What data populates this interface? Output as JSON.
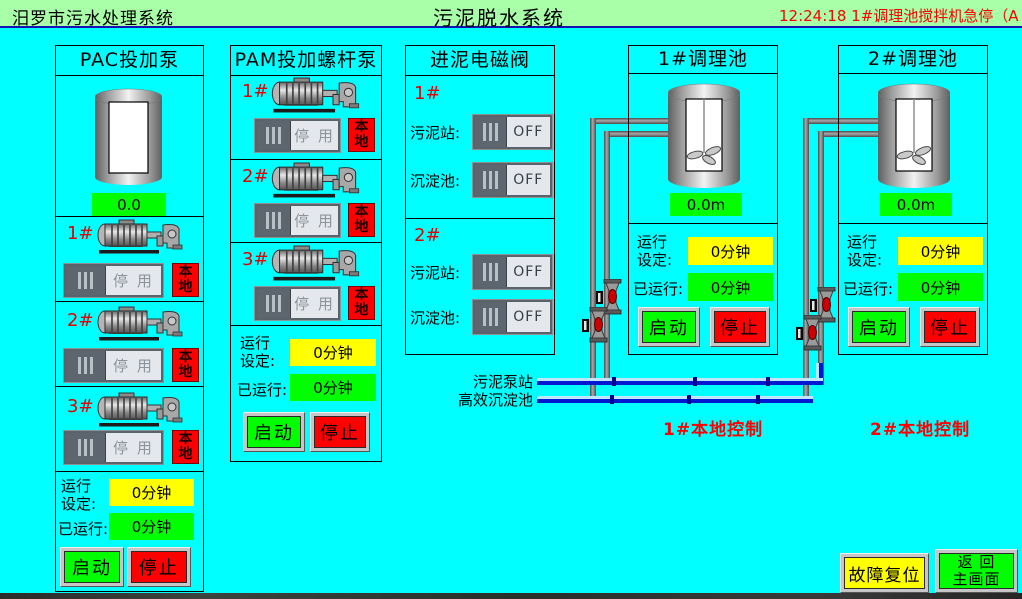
{
  "header": {
    "left_title": "汨罗市污水处理系统",
    "center_title": "污泥脱水系统",
    "time": "12:24:18",
    "alarm_message": "1#调理池搅拌机急停（A"
  },
  "labels": {
    "switch_stopped": "停 用",
    "switch_off": "OFF",
    "local_badge": "本地",
    "start_button": "启动",
    "stop_button": "停止",
    "run_set_line1": "运行",
    "run_set_line2": "设定:",
    "elapsed_label": "已运行:"
  },
  "pac_panel": {
    "title": "PAC投加泵",
    "tank_value": "0.0",
    "pumps": [
      {
        "id": "1#"
      },
      {
        "id": "2#"
      },
      {
        "id": "3#"
      }
    ],
    "run_set_value": "0分钟",
    "elapsed_value": "0分钟"
  },
  "pam_panel": {
    "title": "PAM投加螺杆泵",
    "pumps": [
      {
        "id": "1#"
      },
      {
        "id": "2#"
      },
      {
        "id": "3#"
      }
    ],
    "run_set_value": "0分钟",
    "elapsed_value": "0分钟"
  },
  "valve_panel": {
    "title": "进泥电磁阀",
    "groups": [
      {
        "id": "1#",
        "rows": [
          {
            "label": "污泥站:",
            "state": "OFF"
          },
          {
            "label": "沉淀池:",
            "state": "OFF"
          }
        ]
      },
      {
        "id": "2#",
        "rows": [
          {
            "label": "污泥站:",
            "state": "OFF"
          },
          {
            "label": "沉淀池:",
            "state": "OFF"
          }
        ]
      }
    ]
  },
  "tank1_panel": {
    "title": "1#调理池",
    "level_value": "0.0m",
    "run_set_value": "0分钟",
    "elapsed_value": "0分钟",
    "control_note": "1#本地控制"
  },
  "tank2_panel": {
    "title": "2#调理池",
    "level_value": "0.0m",
    "run_set_value": "0分钟",
    "elapsed_value": "0分钟",
    "control_note": "2#本地控制"
  },
  "pipes": {
    "source_top": "污泥泵站",
    "source_bottom": "高效沉淀池"
  },
  "footer": {
    "fault_reset": "故障复位",
    "return_line1": "返 回",
    "return_line2": "主画面"
  },
  "colors": {
    "background": "#00ffff",
    "header_bg": "#a8ffa8",
    "alarm_red": "#ff0000",
    "value_green": "#00ff00",
    "value_yellow": "#ffff00",
    "badge_red": "#ff0000",
    "pipe_blue": "#0018d0"
  }
}
